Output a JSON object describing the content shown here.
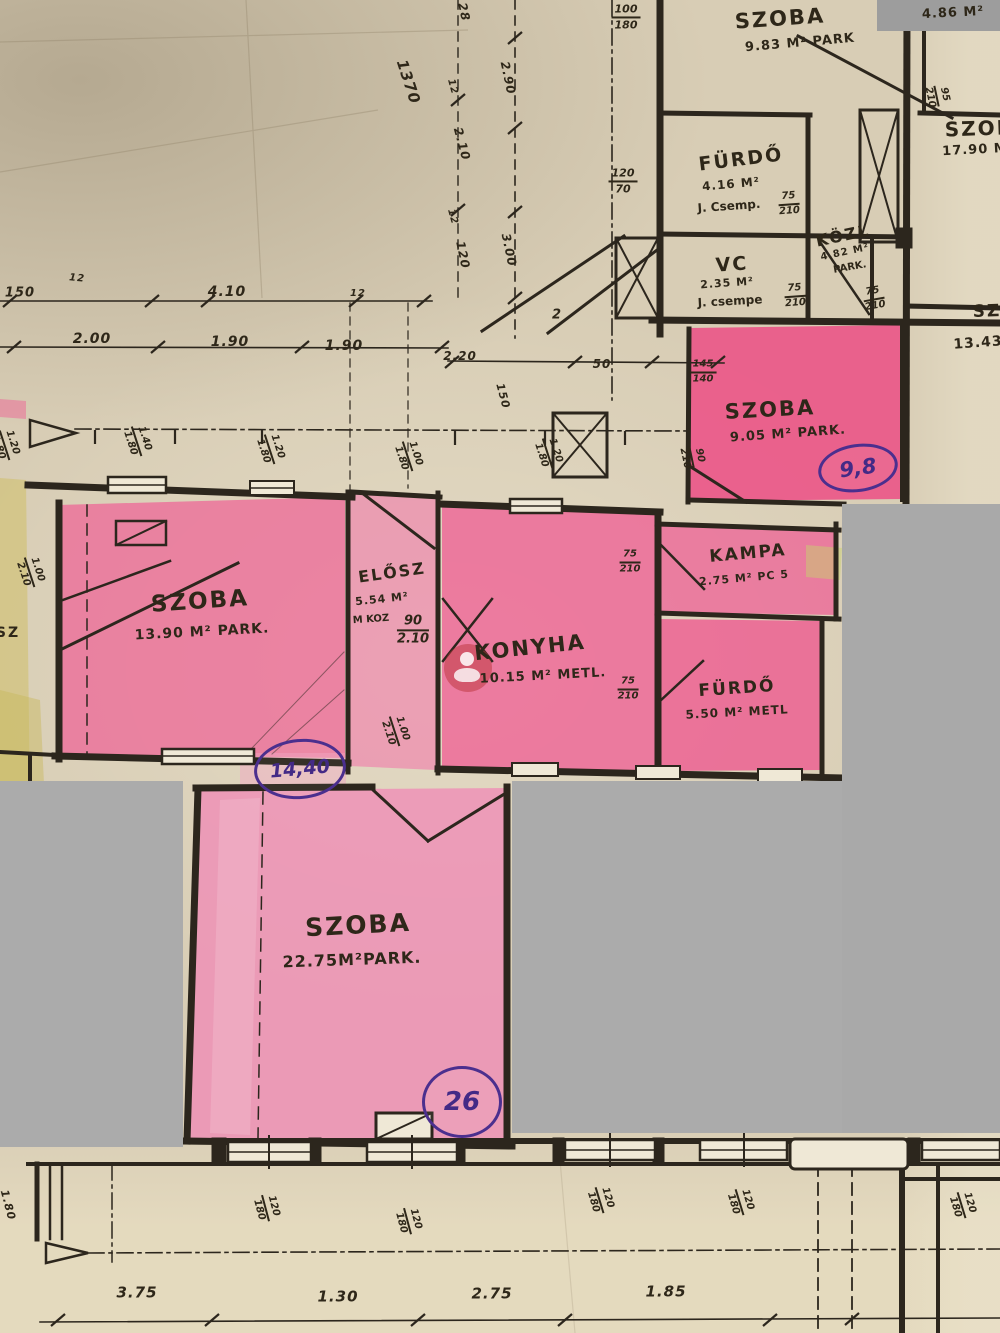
{
  "document": {
    "kind": "hand-annotated apartment floor plan photo",
    "language": "Hungarian"
  },
  "colors": {
    "paper": "#d8cdb5",
    "ink": "#2e2719",
    "pink_highlight": "#ee5f92",
    "pink_light": "#f08cb6",
    "gray_mask": "#ababab",
    "purple_ink": "#4b2f8e",
    "yellow_highlight": "#cfc068",
    "watermark_red": "#ba343a"
  },
  "labels": [
    {
      "n": "room-szoba-983-name",
      "k": "room",
      "t": "SZOBA",
      "x": 780,
      "y": 19,
      "s": 21,
      "r": -4
    },
    {
      "n": "room-szoba-983-area",
      "k": "area",
      "t": "9.83 M² PARK",
      "x": 800,
      "y": 43,
      "s": 13,
      "r": -5
    },
    {
      "n": "room-486-area",
      "k": "area",
      "t": "4.86 M²",
      "x": 953,
      "y": 13,
      "s": 13,
      "r": -3
    },
    {
      "n": "room-furdo-416-name",
      "k": "room",
      "t": "FÜRDŐ",
      "x": 741,
      "y": 160,
      "s": 19,
      "r": -7
    },
    {
      "n": "room-furdo-416-area",
      "k": "area",
      "t": "4.16 M²",
      "x": 731,
      "y": 184,
      "s": 12,
      "r": -5
    },
    {
      "n": "room-furdo-416-note",
      "k": "note",
      "t": "J. Csemp.",
      "x": 729,
      "y": 206,
      "s": 12,
      "r": -4
    },
    {
      "n": "room-vc-name",
      "k": "room",
      "t": "VC",
      "x": 732,
      "y": 265,
      "s": 19,
      "r": -4
    },
    {
      "n": "room-vc-area",
      "k": "area",
      "t": "2.35 M²",
      "x": 727,
      "y": 283,
      "s": 11,
      "r": -4
    },
    {
      "n": "room-vc-note",
      "k": "note",
      "t": "J. csempe",
      "x": 730,
      "y": 301,
      "s": 12,
      "r": -3
    },
    {
      "n": "room-kozl-name",
      "k": "room",
      "t": "KÖZL",
      "x": 843,
      "y": 236,
      "s": 16,
      "r": -12
    },
    {
      "n": "room-kozl-area",
      "k": "area",
      "t": "4.82 M²",
      "x": 845,
      "y": 253,
      "s": 10,
      "r": -12
    },
    {
      "n": "room-kozl-note",
      "k": "note",
      "t": "PARK.",
      "x": 850,
      "y": 268,
      "s": 10,
      "r": -10
    },
    {
      "n": "room-szoba-1790-name",
      "k": "room",
      "t": "SZOBA",
      "x": 988,
      "y": 128,
      "s": 20,
      "r": -2
    },
    {
      "n": "room-szoba-1790-area",
      "k": "area",
      "t": "17.90 M",
      "x": 975,
      "y": 150,
      "s": 13,
      "r": -3
    },
    {
      "n": "room-sz-1343-name",
      "k": "room",
      "t": "SZ",
      "x": 987,
      "y": 312,
      "s": 17,
      "r": -2
    },
    {
      "n": "room-sz-1343-area",
      "k": "area",
      "t": "13.43",
      "x": 978,
      "y": 343,
      "s": 14,
      "r": -4
    },
    {
      "n": "room-szoba-905-name",
      "k": "room",
      "t": "SZOBA",
      "x": 770,
      "y": 410,
      "s": 21,
      "r": -3
    },
    {
      "n": "room-szoba-905-area",
      "k": "area",
      "t": "9.05 M² PARK.",
      "x": 788,
      "y": 434,
      "s": 13,
      "r": -4
    },
    {
      "n": "room-szoba-1390-name",
      "k": "room",
      "t": "SZOBA",
      "x": 200,
      "y": 602,
      "s": 23,
      "r": -4
    },
    {
      "n": "room-szoba-1390-area",
      "k": "area",
      "t": "13.90 M² PARK.",
      "x": 202,
      "y": 632,
      "s": 14,
      "r": -3
    },
    {
      "n": "room-elosz-name",
      "k": "room",
      "t": "ELŐSZ",
      "x": 392,
      "y": 573,
      "s": 16,
      "r": -8
    },
    {
      "n": "room-elosz-area",
      "k": "area",
      "t": "5.54 M²",
      "x": 382,
      "y": 599,
      "s": 11,
      "r": -6
    },
    {
      "n": "room-elosz-note",
      "k": "note",
      "t": "M KOZ",
      "x": 371,
      "y": 620,
      "s": 10,
      "r": -4
    },
    {
      "n": "room-konyha-name",
      "k": "room",
      "t": "KONYHA",
      "x": 530,
      "y": 648,
      "s": 21,
      "r": -6
    },
    {
      "n": "room-konyha-area",
      "k": "area",
      "t": "10.15 M² METL.",
      "x": 543,
      "y": 676,
      "s": 13,
      "r": -3
    },
    {
      "n": "room-kampa-name",
      "k": "room",
      "t": "KAMPA",
      "x": 748,
      "y": 554,
      "s": 17,
      "r": -5
    },
    {
      "n": "room-kampa-area",
      "k": "area",
      "t": "2.75 M² PC 5",
      "x": 744,
      "y": 578,
      "s": 11,
      "r": -5
    },
    {
      "n": "room-furdo-550-name",
      "k": "room",
      "t": "FÜRDŐ",
      "x": 737,
      "y": 689,
      "s": 17,
      "r": -4
    },
    {
      "n": "room-furdo-550-area",
      "k": "area",
      "t": "5.50 M² METL",
      "x": 737,
      "y": 712,
      "s": 12,
      "r": -3
    },
    {
      "n": "room-szoba-2275-name",
      "k": "room",
      "t": "SZOBA",
      "x": 358,
      "y": 925,
      "s": 25,
      "r": -3
    },
    {
      "n": "room-szoba-2275-area",
      "k": "area",
      "t": "22.75M²PARK.",
      "x": 352,
      "y": 960,
      "s": 16,
      "r": -2
    },
    {
      "n": "edge-label-sz",
      "k": "room",
      "t": "SZ",
      "x": 8,
      "y": 633,
      "s": 14,
      "r": 0
    },
    {
      "n": "dim-1370",
      "k": "dim",
      "t": "1370",
      "x": 408,
      "y": 82,
      "s": 15,
      "r": 72
    },
    {
      "n": "dim-28",
      "k": "dim",
      "t": "28",
      "x": 464,
      "y": 12,
      "s": 12,
      "r": 78
    },
    {
      "n": "dim-12-a",
      "k": "dim",
      "t": "12",
      "x": 452,
      "y": 87,
      "s": 10,
      "r": 75
    },
    {
      "n": "dim-290",
      "k": "dim",
      "t": "2.90",
      "x": 508,
      "y": 78,
      "s": 12,
      "r": 78
    },
    {
      "n": "dim-210-v",
      "k": "dim",
      "t": "2.10",
      "x": 462,
      "y": 144,
      "s": 12,
      "r": 75
    },
    {
      "n": "dim-12-b",
      "k": "dim",
      "t": "12",
      "x": 452,
      "y": 217,
      "s": 10,
      "r": 75
    },
    {
      "n": "dim-120-v",
      "k": "dim",
      "t": "120",
      "x": 463,
      "y": 255,
      "s": 12,
      "r": 78
    },
    {
      "n": "dim-300",
      "k": "dim",
      "t": "3.00",
      "x": 509,
      "y": 250,
      "s": 12,
      "r": 78
    },
    {
      "n": "dim-2",
      "k": "dim",
      "t": "2",
      "x": 557,
      "y": 315,
      "s": 13,
      "r": 0
    },
    {
      "n": "dim-150",
      "k": "dim",
      "t": "150",
      "x": 20,
      "y": 293,
      "s": 13,
      "r": 0
    },
    {
      "n": "dim-12-c",
      "k": "dim",
      "t": "12",
      "x": 77,
      "y": 279,
      "s": 10,
      "r": 5
    },
    {
      "n": "dim-410",
      "k": "dim",
      "t": "4.10",
      "x": 227,
      "y": 292,
      "s": 14,
      "r": 0
    },
    {
      "n": "dim-12-d",
      "k": "dim",
      "t": "12",
      "x": 358,
      "y": 294,
      "s": 10,
      "r": 0
    },
    {
      "n": "dim-200",
      "k": "dim",
      "t": "2.00",
      "x": 92,
      "y": 339,
      "s": 14,
      "r": 0
    },
    {
      "n": "dim-190-a",
      "k": "dim",
      "t": "1.90",
      "x": 230,
      "y": 342,
      "s": 14,
      "r": 0
    },
    {
      "n": "dim-190-b",
      "k": "dim",
      "t": "1.90",
      "x": 344,
      "y": 346,
      "s": 14,
      "r": 0
    },
    {
      "n": "dim-220",
      "k": "dim",
      "t": "2.20",
      "x": 460,
      "y": 356,
      "s": 12,
      "r": 0
    },
    {
      "n": "dim-50",
      "k": "dim",
      "t": "50",
      "x": 602,
      "y": 364,
      "s": 12,
      "r": 0
    },
    {
      "n": "dim-150-v",
      "k": "dim",
      "t": "150",
      "x": 503,
      "y": 396,
      "s": 11,
      "r": 75
    },
    {
      "n": "dim-375",
      "k": "dim",
      "t": "3.75",
      "x": 137,
      "y": 1293,
      "s": 15,
      "r": 0
    },
    {
      "n": "dim-130",
      "k": "dim",
      "t": "1.30",
      "x": 338,
      "y": 1297,
      "s": 15,
      "r": 0
    },
    {
      "n": "dim-275",
      "k": "dim",
      "t": "2.75",
      "x": 492,
      "y": 1294,
      "s": 15,
      "r": 0
    },
    {
      "n": "dim-185",
      "k": "dim",
      "t": "1.85",
      "x": 666,
      "y": 1292,
      "s": 15,
      "r": 0
    },
    {
      "n": "dim-180-v",
      "k": "dim",
      "t": "1.80",
      "x": 8,
      "y": 1205,
      "s": 11,
      "r": 75
    }
  ],
  "fractions": [
    {
      "n": "window-100-180-top",
      "top": "100",
      "bottom": "180",
      "x": 626,
      "y": 17,
      "s": 11,
      "r": 0
    },
    {
      "n": "door-120-70",
      "top": "120",
      "bottom": "70",
      "x": 623,
      "y": 181,
      "s": 11,
      "r": 0
    },
    {
      "n": "door-75-210-furdo416",
      "top": "75",
      "bottom": "210",
      "x": 789,
      "y": 204,
      "s": 10,
      "r": -4
    },
    {
      "n": "door-75-210-vc",
      "top": "75",
      "bottom": "210",
      "x": 795,
      "y": 296,
      "s": 10,
      "r": -4
    },
    {
      "n": "door-75-210-kozl",
      "top": "75",
      "bottom": "210",
      "x": 874,
      "y": 299,
      "s": 10,
      "r": -10
    },
    {
      "n": "door-95-210",
      "top": "95",
      "bottom": "210",
      "x": 937,
      "y": 96,
      "s": 10,
      "r": 78
    },
    {
      "n": "dim-145-140",
      "top": "145",
      "bottom": "140",
      "x": 703,
      "y": 372,
      "s": 10,
      "r": 0
    },
    {
      "n": "window-140-180",
      "top": "1.40",
      "bottom": "1.80",
      "x": 137,
      "y": 441,
      "s": 10,
      "r": 72
    },
    {
      "n": "window-120-180-a",
      "top": "1.20",
      "bottom": "1.80",
      "x": 270,
      "y": 449,
      "s": 10,
      "r": 72
    },
    {
      "n": "window-100-180-mid",
      "top": "1.00",
      "bottom": "1.80",
      "x": 408,
      "y": 456,
      "s": 10,
      "r": 72
    },
    {
      "n": "window-120-180-b",
      "top": "1.20",
      "bottom": "1.80",
      "x": 548,
      "y": 453,
      "s": 10,
      "r": 72
    },
    {
      "n": "door-90-210-szoba905",
      "top": "90",
      "bottom": "210",
      "x": 692,
      "y": 457,
      "s": 10,
      "r": 78
    },
    {
      "n": "window-120-180-edge",
      "top": "1.20",
      "bottom": "1.80",
      "x": 5,
      "y": 445,
      "s": 10,
      "r": 72
    },
    {
      "n": "door-90-210-elosz",
      "top": "90",
      "bottom": "2.10",
      "x": 413,
      "y": 630,
      "s": 13,
      "r": 0
    },
    {
      "n": "door-100-210-left",
      "top": "1.00",
      "bottom": "2.10",
      "x": 30,
      "y": 572,
      "s": 10,
      "r": 72
    },
    {
      "n": "door-100-210-elosz-bottom",
      "top": "1.00",
      "bottom": "2.10",
      "x": 395,
      "y": 731,
      "s": 10,
      "r": 72
    },
    {
      "n": "door-75-210-kampa",
      "top": "75",
      "bottom": "210",
      "x": 630,
      "y": 562,
      "s": 10,
      "r": 0
    },
    {
      "n": "door-75-210-furdo550",
      "top": "75",
      "bottom": "210",
      "x": 628,
      "y": 689,
      "s": 10,
      "r": 0
    },
    {
      "n": "window-120-180-bottom1",
      "top": "120",
      "bottom": "180",
      "x": 266,
      "y": 1208,
      "s": 10,
      "r": 75
    },
    {
      "n": "window-120-180-bottom2",
      "top": "120",
      "bottom": "180",
      "x": 408,
      "y": 1221,
      "s": 10,
      "r": 75
    },
    {
      "n": "window-120-180-bottom3",
      "top": "120",
      "bottom": "180",
      "x": 600,
      "y": 1200,
      "s": 10,
      "r": 73
    },
    {
      "n": "window-120-180-bottom4",
      "top": "120",
      "bottom": "180",
      "x": 740,
      "y": 1202,
      "s": 10,
      "r": 73
    },
    {
      "n": "window-120-180-bottom5",
      "top": "120",
      "bottom": "180",
      "x": 962,
      "y": 1205,
      "s": 10,
      "r": 73
    }
  ],
  "circles": [
    {
      "n": "ink-circle-9-8",
      "t": "9,8",
      "x": 858,
      "y": 468,
      "rx": 37,
      "ry": 21,
      "s": 21,
      "r": -8
    },
    {
      "n": "ink-circle-14-40",
      "t": "14,40",
      "x": 300,
      "y": 769,
      "rx": 43,
      "ry": 27,
      "s": 19,
      "r": -5
    },
    {
      "n": "ink-circle-26",
      "t": "26",
      "x": 462,
      "y": 1102,
      "rx": 37,
      "ry": 33,
      "s": 26,
      "r": 0
    }
  ]
}
